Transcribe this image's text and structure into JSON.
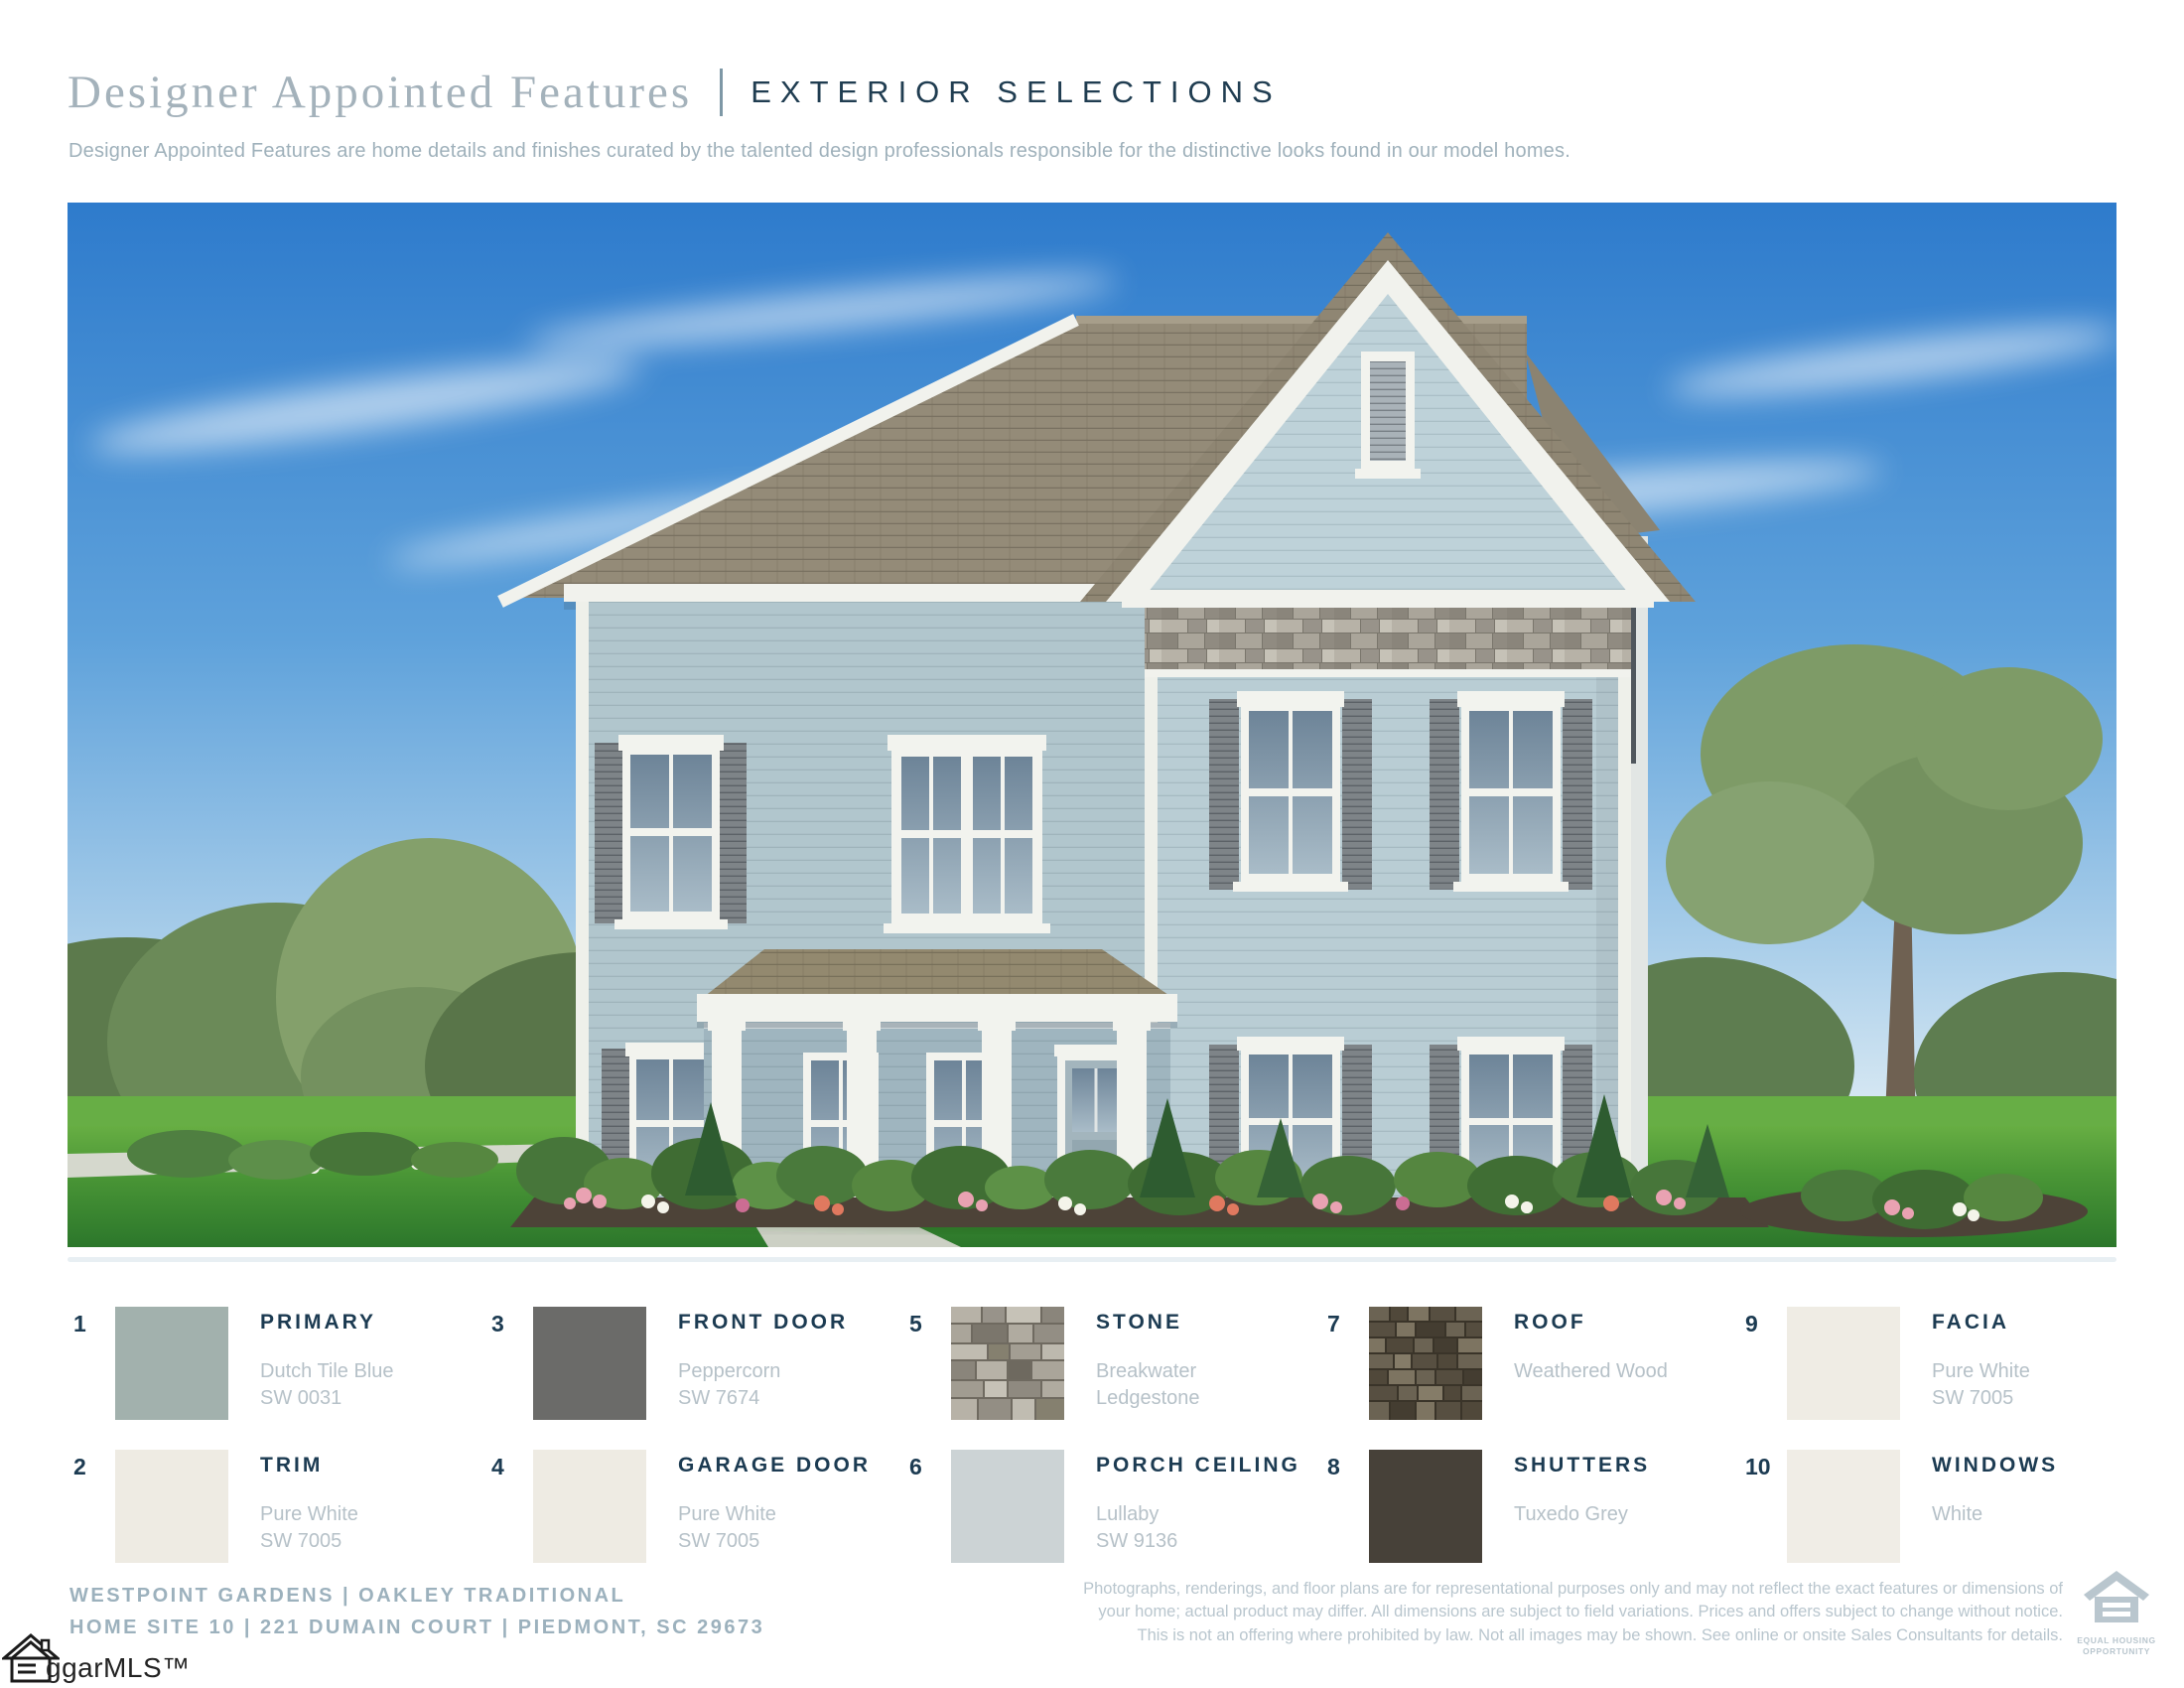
{
  "header": {
    "title": "Designer Appointed Features",
    "section": "EXTERIOR SELECTIONS",
    "subtitle": "Designer Appointed Features are home details and finishes curated by the talented design professionals responsible for the distinctive looks found in our model homes."
  },
  "swatches": [
    {
      "number": "1",
      "label": "PRIMARY",
      "line1": "Dutch Tile Blue",
      "line2": "SW 0031",
      "color": "#a2b1ad"
    },
    {
      "number": "2",
      "label": "TRIM",
      "line1": "Pure White",
      "line2": "SW 7005",
      "color": "#eeebe3"
    },
    {
      "number": "3",
      "label": "FRONT DOOR",
      "line1": "Peppercorn",
      "line2": "SW 7674",
      "color": "#6b6b69"
    },
    {
      "number": "4",
      "label": "GARAGE DOOR",
      "line1": "Pure White",
      "line2": "SW 7005",
      "color": "#eeebe3"
    },
    {
      "number": "5",
      "label": "STONE",
      "line1": "Breakwater",
      "line2": "Ledgestone",
      "texture": "stone"
    },
    {
      "number": "6",
      "label": "PORCH CEILING",
      "line1": "Lullaby",
      "line2": "SW 9136",
      "color": "#ccd3d5"
    },
    {
      "number": "7",
      "label": "ROOF",
      "line1": "Weathered Wood",
      "line2": "",
      "texture": "shingles"
    },
    {
      "number": "8",
      "label": "SHUTTERS",
      "line1": "Tuxedo Grey",
      "line2": "",
      "color": "#474139"
    },
    {
      "number": "9",
      "label": "FACIA",
      "line1": "Pure White",
      "line2": "SW 7005",
      "color": "#efece4"
    },
    {
      "number": "10",
      "label": "WINDOWS",
      "line1": "White",
      "line2": "",
      "color": "#f0ede6"
    }
  ],
  "footer": {
    "community_line": "WESTPOINT GARDENS | OAKLEY TRADITIONAL",
    "address_line": "HOME SITE 10 | 221 DUMAIN COURT | PIEDMONT, SC 29673",
    "disclaimer_line1": "Photographs, renderings, and floor plans are for representational purposes only and may not reflect the exact features or dimensions of",
    "disclaimer_line2": "your home; actual product may differ. All dimensions are subject to field variations. Prices and offers subject to change without notice.",
    "disclaimer_line3": "This is not an offering where prohibited by law. Not all images may be shown. See online or onsite Sales Consultants for details.",
    "equal_housing_line1": "EQUAL HOUSING",
    "equal_housing_line2": "OPPORTUNITY",
    "mls_logo_text": "ggarMLS™"
  },
  "colors": {
    "accent_navy": "#1c3b52",
    "muted_blue_gray": "#9cb1bd",
    "light_text": "#b6c1c8",
    "title_gray": "#a4b2bb"
  }
}
